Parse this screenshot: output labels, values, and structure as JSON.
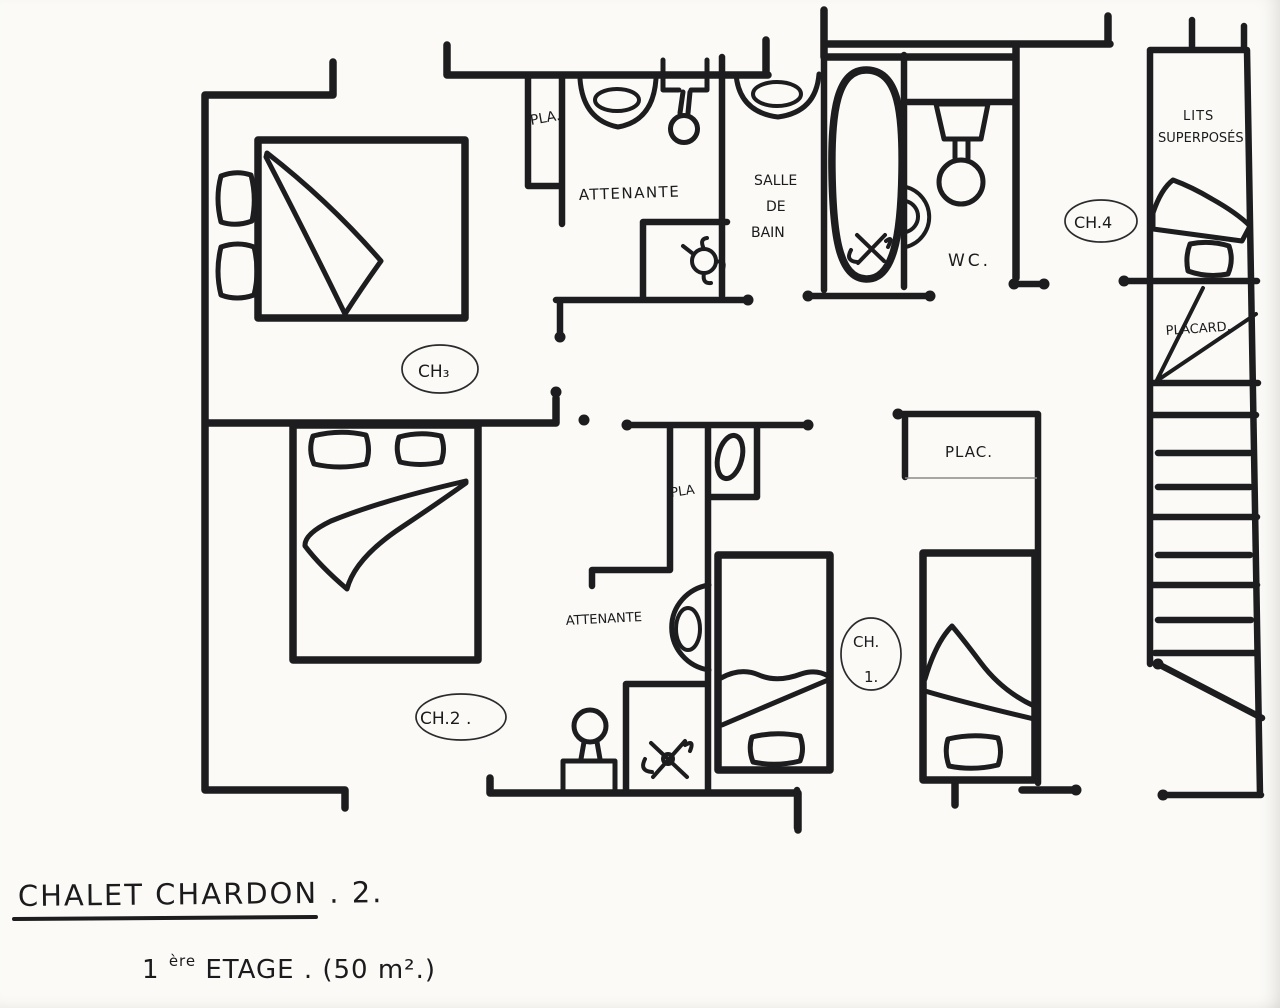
{
  "document": {
    "type": "hand-drawn floor plan (scan)",
    "title": "CHALET CHARDON . 2.",
    "subtitle_num": "1",
    "subtitle_sup": "ère",
    "subtitle_rest": " ETAGE . (50 m².)"
  },
  "rooms": {
    "ch3": "CH₃",
    "ch2": "CH.2 .",
    "ch1_line1": "CH.",
    "ch1_line2": "1.",
    "ch4": "CH.4",
    "attenante_top": "ATTENANTE",
    "attenante_bottom": "ATTENANTE",
    "salle_de_bain_1": "SALLE",
    "salle_de_bain_2": "DE",
    "salle_de_bain_3": "BAIN",
    "wc": "WC.",
    "pla_top": "PLA.",
    "pla_mid": "PLA",
    "plac": "PLAC.",
    "placard": "PLACARD.",
    "lits_1": "LITS",
    "lits_2": "SUPERPOSÉS"
  },
  "colors": {
    "ink": "#1d1d1f",
    "paper": "#fbfaf7"
  }
}
